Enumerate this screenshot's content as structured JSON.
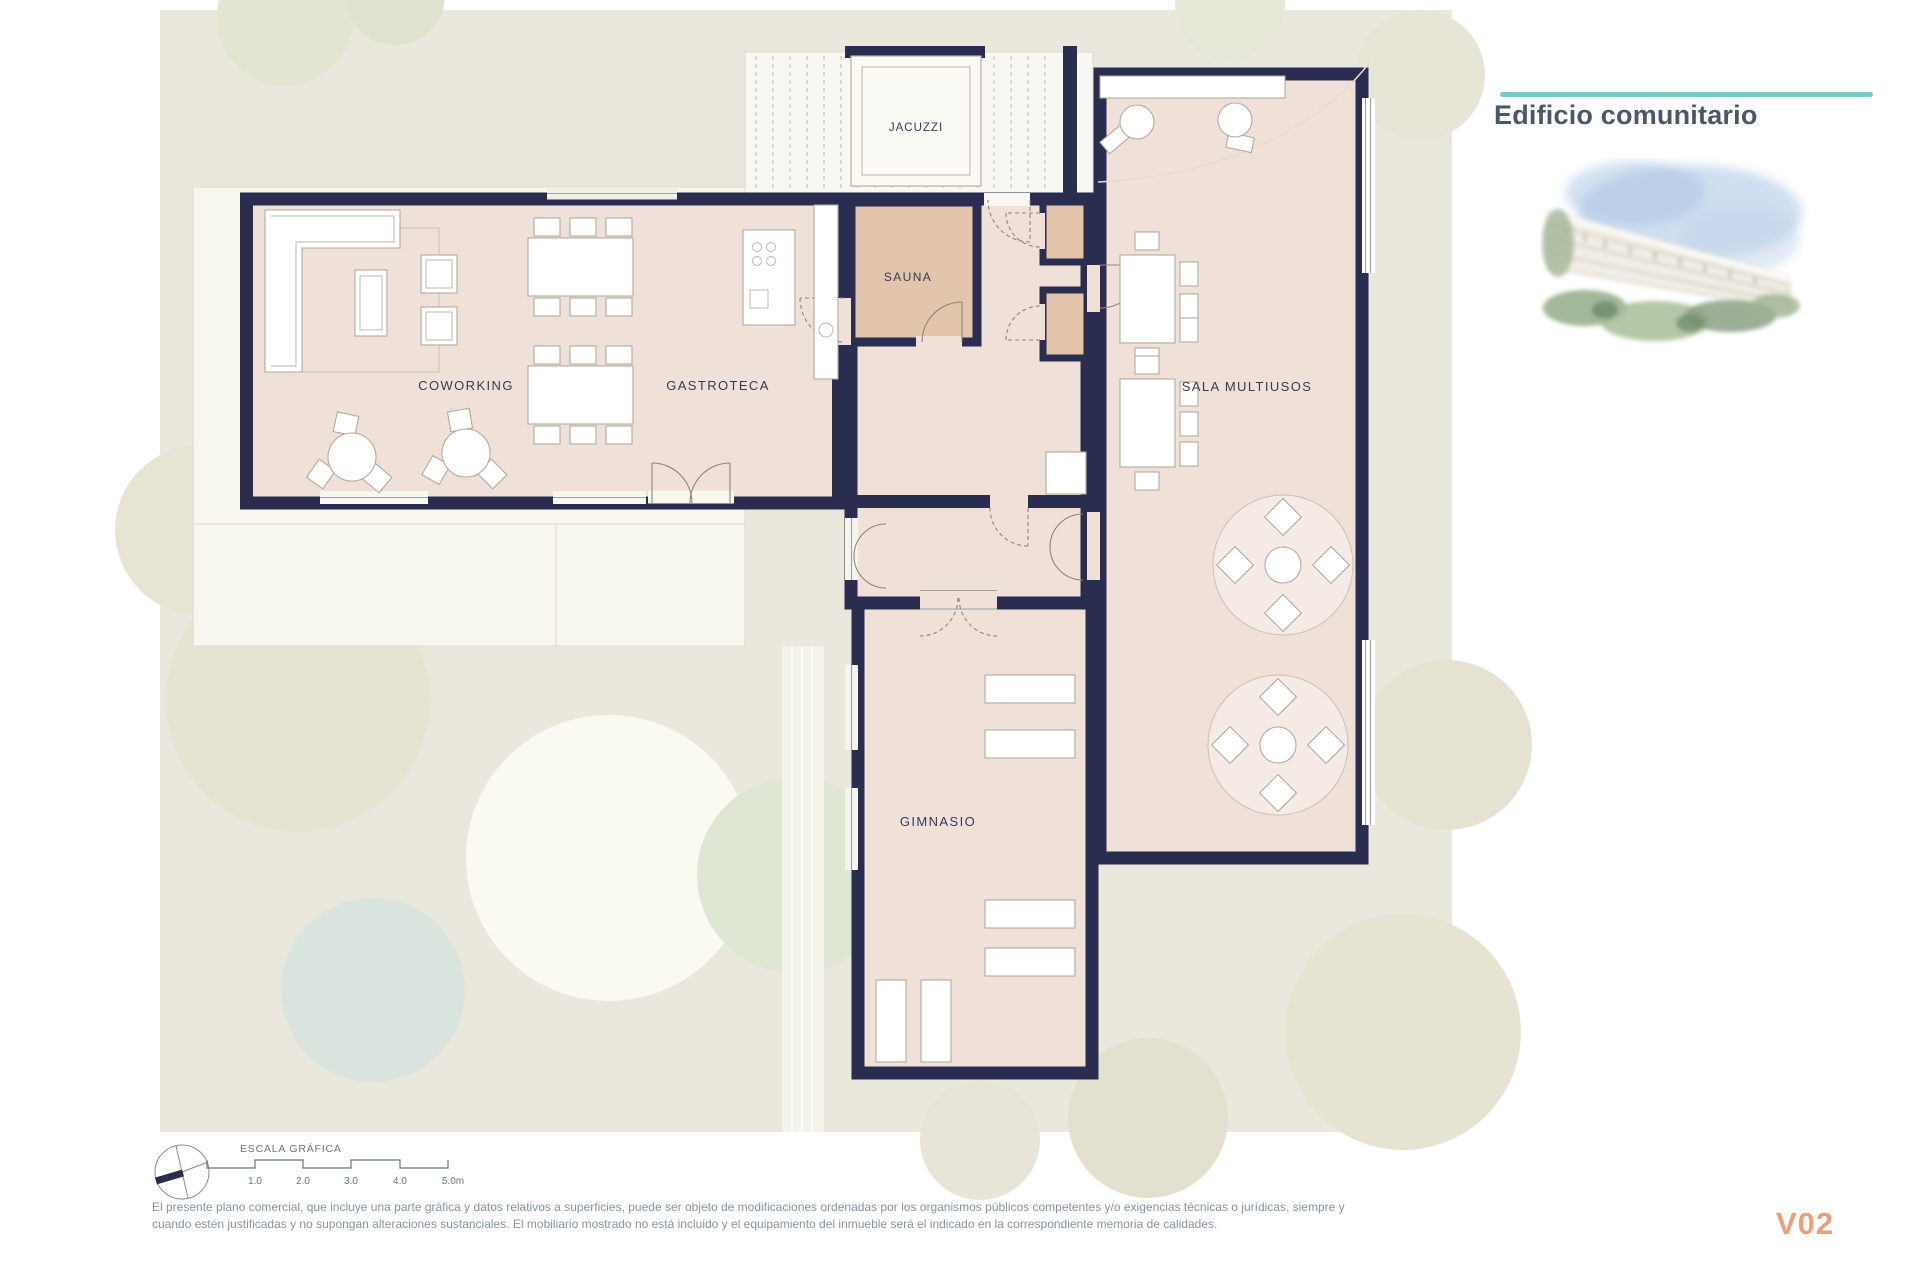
{
  "header": {
    "title": "Edificio comunitario"
  },
  "plan": {
    "rooms": {
      "jacuzzi": {
        "label": "JACUZZI"
      },
      "sauna": {
        "label": "SAUNA"
      },
      "coworking": {
        "label": "COWORKING"
      },
      "gastroteca": {
        "label": "GASTROTECA"
      },
      "sala_multiusos": {
        "label": "SALA MULTIUSOS"
      },
      "gimnasio": {
        "label": "GIMNASIO"
      }
    }
  },
  "scalebar": {
    "title": "ESCALA GRÁFICA",
    "ticks": [
      "1.0",
      "2.0",
      "3.0",
      "4.0",
      "5.0m"
    ]
  },
  "footer": {
    "disclaimer_line1": "El presente plano comercial, que incluye una parte gráfica y datos relativos a superficies, puede ser objeto de modificaciones ordenadas por los organismos públicos competentes y/o exigencias técnicas o jurídicas, siempre y",
    "disclaimer_line2": "cuando estén justificadas y no supongan alteraciones sustanciales. El mobiliario mostrado no está incluido y el equipamiento del inmueble será el indicado en la correspondiente memoria de calidades.",
    "version": "V02"
  },
  "colors": {
    "accent_teal": "#7ecac5",
    "version_orange": "#eb9e77",
    "wall_navy": "#2a2d4f",
    "floor_pink": "#f0e1d8",
    "sauna_tan": "#e2c5ab",
    "site_beige": "#eae8dc"
  }
}
